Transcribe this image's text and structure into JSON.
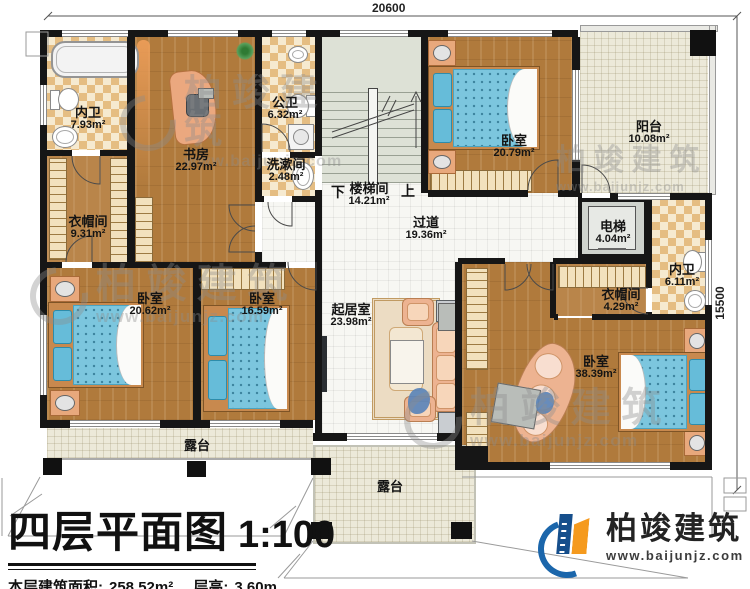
{
  "dimensions": {
    "width_mm": "20600",
    "height_mm": "15500"
  },
  "rooms": [
    {
      "id": "neiwei-top",
      "name": "内卫",
      "area": "7.93m²"
    },
    {
      "id": "shufang",
      "name": "书房",
      "area": "22.97m²"
    },
    {
      "id": "gongwei",
      "name": "公卫",
      "area": "6.32m²"
    },
    {
      "id": "xishujian",
      "name": "洗漱间",
      "area": "2.48m²"
    },
    {
      "id": "loutijian",
      "name": "楼梯间",
      "area": "14.21m²"
    },
    {
      "id": "woshi-north",
      "name": "卧室",
      "area": "20.79m²"
    },
    {
      "id": "yangtai",
      "name": "阳台",
      "area": "10.08m²"
    },
    {
      "id": "dianti",
      "name": "电梯",
      "area": "4.04m²"
    },
    {
      "id": "neiwei-east",
      "name": "内卫",
      "area": "6.11m²"
    },
    {
      "id": "yimaojian-west",
      "name": "衣帽间",
      "area": "9.31m²"
    },
    {
      "id": "woshi-sw",
      "name": "卧室",
      "area": "20.62m²"
    },
    {
      "id": "woshi-south",
      "name": "卧室",
      "area": "16.59m²"
    },
    {
      "id": "guodao",
      "name": "过道",
      "area": "19.36m²"
    },
    {
      "id": "qijushi",
      "name": "起居室",
      "area": "23.98m²"
    },
    {
      "id": "yimaojian-east",
      "name": "衣帽间",
      "area": "4.29m²"
    },
    {
      "id": "woshi-master",
      "name": "卧室",
      "area": "38.39m²"
    }
  ],
  "stairs": {
    "down_label": "下",
    "up_label": "上"
  },
  "terraces": {
    "left": "露台",
    "center": "露台"
  },
  "title_block": {
    "title": "四层平面图",
    "scale": "1:100",
    "area_label": "本层建筑面积:",
    "area_value": "258.52m²",
    "height_label": "层高:",
    "height_value": "3.60m"
  },
  "branding": {
    "company": "柏竣建筑",
    "website": "www.baijunjz.com"
  },
  "watermark": {
    "company": "柏竣建筑",
    "website": "www.baijunjz.com"
  },
  "colors": {
    "wall": "#161616",
    "wood": "#b07a3c",
    "checker": "#e5bd82",
    "tile": "#ece9d9",
    "mattress": "#7cc6de",
    "brand_blue": "#1b66ab",
    "brand_orange": "#f59a1e"
  }
}
